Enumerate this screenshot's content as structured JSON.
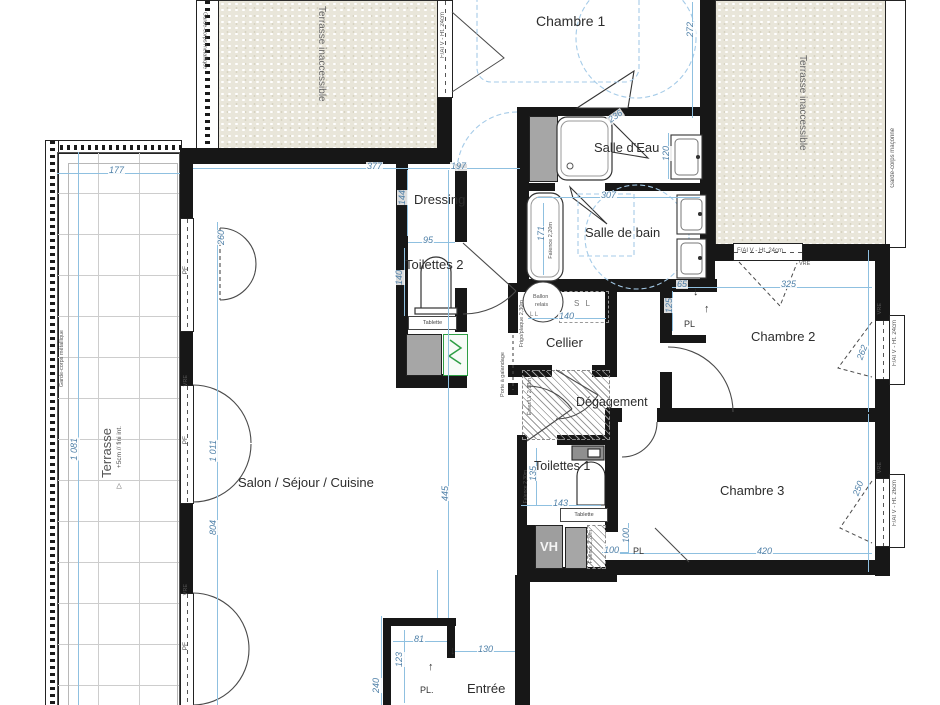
{
  "plan": {
    "rooms": {
      "chambre1": "Chambre 1",
      "salle_eau": "Salle d'Eau",
      "salle_de_bain": "Salle de bain",
      "dressing": "Dressing",
      "toilettes2": "Toilettes 2",
      "toilettes1": "Toilettes 1",
      "cellier": "Cellier",
      "degagement": "Dégagement",
      "chambre2": "Chambre 2",
      "chambre3": "Chambre 3",
      "salon": "Salon / Séjour / Cuisine",
      "entree": "Entrée",
      "terrasse": "Terrasse",
      "terrasse_note": "+5cm // fini int.",
      "terrasse_inaccessible": "Terrasse inaccessible"
    },
    "dims": {
      "d177": "177",
      "d377": "377",
      "d197": "197",
      "d272": "272",
      "d144": "144",
      "d95": "95",
      "d140": "140",
      "d307": "307",
      "d171": "171",
      "d120": "120",
      "d236": "236",
      "d65": "65",
      "d125": "125",
      "d325": "325",
      "d262": "262",
      "d420": "420",
      "d250": "250",
      "d135": "135",
      "d143": "143",
      "d100": "100",
      "d445": "445",
      "d1081": "1 081",
      "d1011": "1 011",
      "d804": "804",
      "d260": "260",
      "d81": "81",
      "d123": "123",
      "d130": "130",
      "d240": "240"
    },
    "labels": {
      "pl": "PL",
      "pl_entree": "PL.",
      "vh": "VH",
      "ballon1": "Ballon",
      "ballon2": "relais",
      "sl": "S L",
      "ll": "L L",
      "tablette": "Tablette",
      "pf": "PF",
      "vre": "VRE",
      "fai24": "F/AI V - Ht. 24cm",
      "fai26": "F/AI V - Ht. 26cm",
      "garde_met": "Garde-corps métallique",
      "garde_mac": "Garde-corps maçonné",
      "galandage": "Porte à galandage",
      "frigo": "Frigo/plaque 2,30m",
      "evier": "Évier/LV 2,13m",
      "fa22": "Faïence 2,20m",
      "fa23": "Faïence 2,30m",
      "up": "↑",
      "down": "↓",
      "tri": "▽"
    },
    "colors": {
      "wall": "#171717",
      "dim_text": "#4f80a8",
      "dim_line": "#8fc0e0",
      "furniture_blue": "#a5cbe8",
      "gravel": "#e9e6da",
      "green_panel": "#2e9e44",
      "shaft_gray": "#a6a6a6"
    }
  }
}
